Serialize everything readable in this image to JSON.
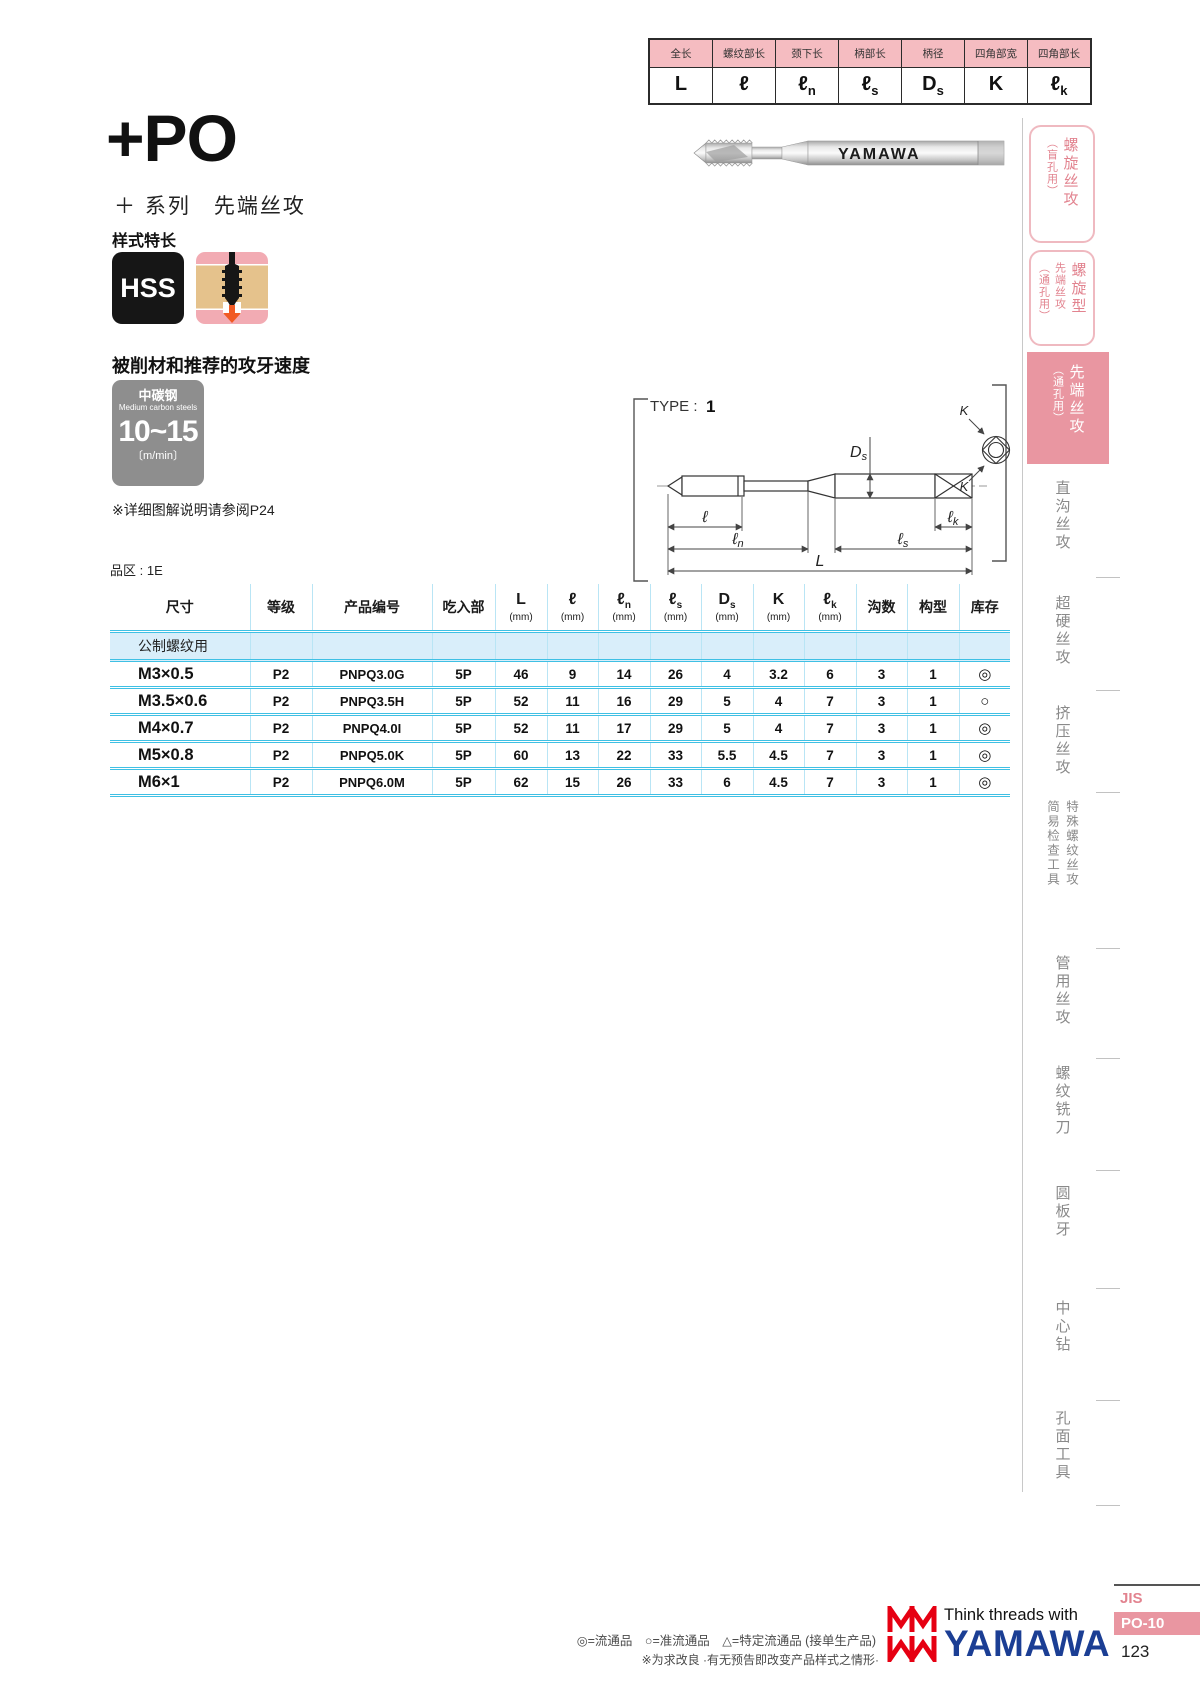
{
  "colors": {
    "pink-light": "#f5bcc1",
    "pink-accent": "#e996a1",
    "pink-text": "#e2838f",
    "cyan-line": "#3fc0e4",
    "section-bg": "#d9eefa",
    "brand-blue": "#1b3e94",
    "brand-red": "#e60012",
    "gray-box": "#8e8e8e",
    "sidebar-gray": "#8a8a8a"
  },
  "dim_table": {
    "headers": [
      "全长",
      "螺纹部长",
      "颈下长",
      "柄部长",
      "柄径",
      "四角部宽",
      "四角部长"
    ],
    "symbols": [
      {
        "main": "L",
        "sub": ""
      },
      {
        "main": "ℓ",
        "sub": ""
      },
      {
        "main": "ℓ",
        "sub": "n"
      },
      {
        "main": "ℓ",
        "sub": "s"
      },
      {
        "main": "D",
        "sub": "s"
      },
      {
        "main": "K",
        "sub": ""
      },
      {
        "main": "ℓ",
        "sub": "k"
      }
    ]
  },
  "header": {
    "series_code": "+PO",
    "series_sub": "＋ 系列　先端丝攻",
    "feature_label": "样式特长",
    "hss": "HSS"
  },
  "speed": {
    "heading": "被削材和推荐的攻牙速度",
    "material_cn": "中碳钢",
    "material_en": "Medium carbon steels",
    "value": "10~15",
    "unit": "〔m/min〕",
    "note": "※详细图解说明请参阅P24"
  },
  "photo": {
    "brand": "YAMAWA"
  },
  "diagram": {
    "type_label": "TYPE :",
    "type_value": "1",
    "sym_l": "ℓ",
    "sub_n": "n",
    "sub_s": "s",
    "sub_k": "k",
    "sym_L": "L",
    "sym_D": "D",
    "sub_Ds": "s",
    "sym_K": "K"
  },
  "zone_label": "品区 : 1E",
  "table": {
    "headers": {
      "size": "尺寸",
      "grade": "等级",
      "part_no": "产品编号",
      "chamfer": "吃入部",
      "unit": "(mm)",
      "flutes": "沟数",
      "form": "构型",
      "stock": "库存"
    },
    "section": "公制螺纹用",
    "rows": [
      {
        "size": "M3×0.5",
        "grade": "P2",
        "part_no": "PNPQ3.0G",
        "chamfer": "5P",
        "L": "46",
        "l": "9",
        "ln": "14",
        "ls": "26",
        "Ds": "4",
        "K": "3.2",
        "lk": "6",
        "flutes": "3",
        "form": "1",
        "stock": "◎"
      },
      {
        "size": "M3.5×0.6",
        "grade": "P2",
        "part_no": "PNPQ3.5H",
        "chamfer": "5P",
        "L": "52",
        "l": "11",
        "ln": "16",
        "ls": "29",
        "Ds": "5",
        "K": "4",
        "lk": "7",
        "flutes": "3",
        "form": "1",
        "stock": "○"
      },
      {
        "size": "M4×0.7",
        "grade": "P2",
        "part_no": "PNPQ4.0I",
        "chamfer": "5P",
        "L": "52",
        "l": "11",
        "ln": "17",
        "ls": "29",
        "Ds": "5",
        "K": "4",
        "lk": "7",
        "flutes": "3",
        "form": "1",
        "stock": "◎"
      },
      {
        "size": "M5×0.8",
        "grade": "P2",
        "part_no": "PNPQ5.0K",
        "chamfer": "5P",
        "L": "60",
        "l": "13",
        "ln": "22",
        "ls": "33",
        "Ds": "5.5",
        "K": "4.5",
        "lk": "7",
        "flutes": "3",
        "form": "1",
        "stock": "◎"
      },
      {
        "size": "M6×1",
        "grade": "P2",
        "part_no": "PNPQ6.0M",
        "chamfer": "5P",
        "L": "62",
        "l": "15",
        "ln": "26",
        "ls": "33",
        "Ds": "6",
        "K": "4.5",
        "lk": "7",
        "flutes": "3",
        "form": "1",
        "stock": "◎"
      }
    ]
  },
  "sidebar": {
    "items": [
      {
        "style": "outlined",
        "cols": [
          "（盲孔用）",
          "螺旋丝攻"
        ]
      },
      {
        "style": "outlined",
        "cols": [
          "（通孔用）",
          "先端丝攻",
          "螺旋型"
        ]
      },
      {
        "style": "active",
        "cols": [
          "（通孔用）",
          "先端丝攻"
        ]
      },
      {
        "style": "plain",
        "cols": [
          "直沟丝攻"
        ]
      },
      {
        "style": "plain",
        "cols": [
          "超硬丝攻"
        ]
      },
      {
        "style": "plain",
        "cols": [
          "挤压丝攻"
        ]
      },
      {
        "style": "plain",
        "cols": [
          "简易检查工具",
          "特殊螺纹丝攻"
        ]
      },
      {
        "style": "plain",
        "cols": [
          "管用丝攻"
        ]
      },
      {
        "style": "plain",
        "cols": [
          "螺纹铣刀"
        ]
      },
      {
        "style": "plain",
        "cols": [
          "圆板牙"
        ]
      },
      {
        "style": "plain",
        "cols": [
          "中心钻"
        ]
      },
      {
        "style": "plain",
        "cols": [
          "孔面工具"
        ]
      }
    ]
  },
  "footer": {
    "legend": "◎=流通品　○=准流通品　△=特定流通品 (接单生产品)",
    "note": "※为求改良 ·有无预告即改变产品样式之情形·",
    "tagline": "Think threads with",
    "brand": "YAMAWA",
    "jis": "JIS",
    "code": "PO-10",
    "page": "123"
  }
}
